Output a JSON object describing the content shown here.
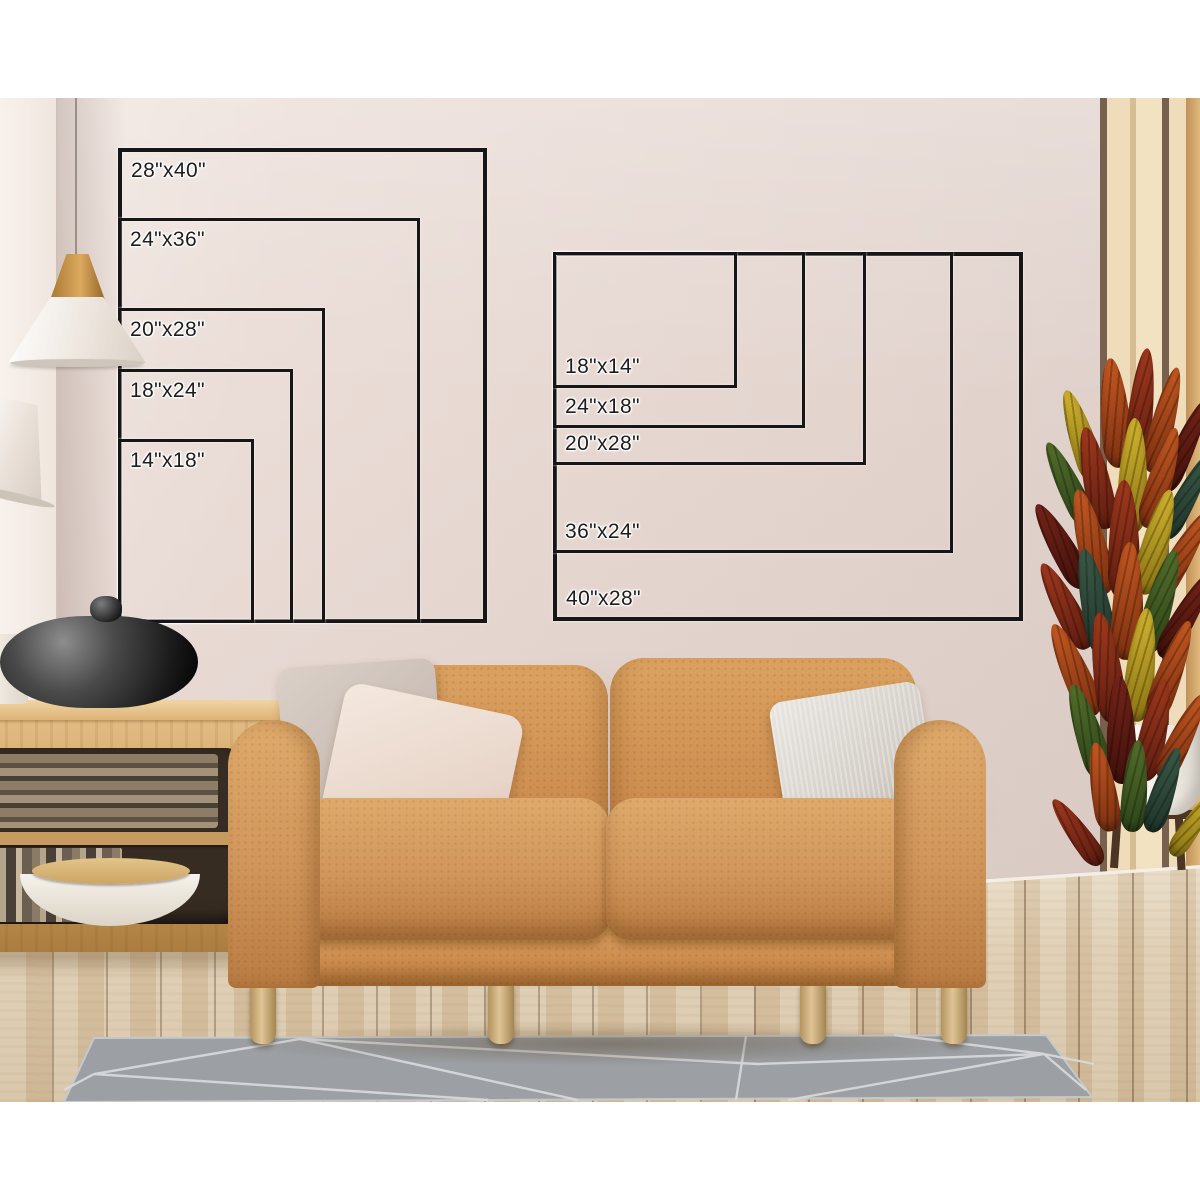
{
  "charts": {
    "portrait": {
      "sizes": [
        {
          "label": "28\"x40\""
        },
        {
          "label": "24\"x36\""
        },
        {
          "label": "20\"x28\""
        },
        {
          "label": "18\"x24\""
        },
        {
          "label": "14\"x18\""
        }
      ]
    },
    "landscape": {
      "sizes": [
        {
          "label": "18\"x14\""
        },
        {
          "label": "24\"x18\""
        },
        {
          "label": "20\"x28\""
        },
        {
          "label": "36\"x24\""
        },
        {
          "label": "40\"x28\""
        }
      ]
    }
  },
  "palette": {
    "chart_line": "#161616",
    "label_text": "#1d1d1d",
    "wall": "#e5d6d0",
    "sofa_leather": "#cf9052",
    "floor_wood": "#dccaac",
    "rug": "#9ca0a4",
    "slat_wood": "#eedcba",
    "plant_red": "#a33a1e",
    "plant_yellow": "#d4b52f"
  }
}
